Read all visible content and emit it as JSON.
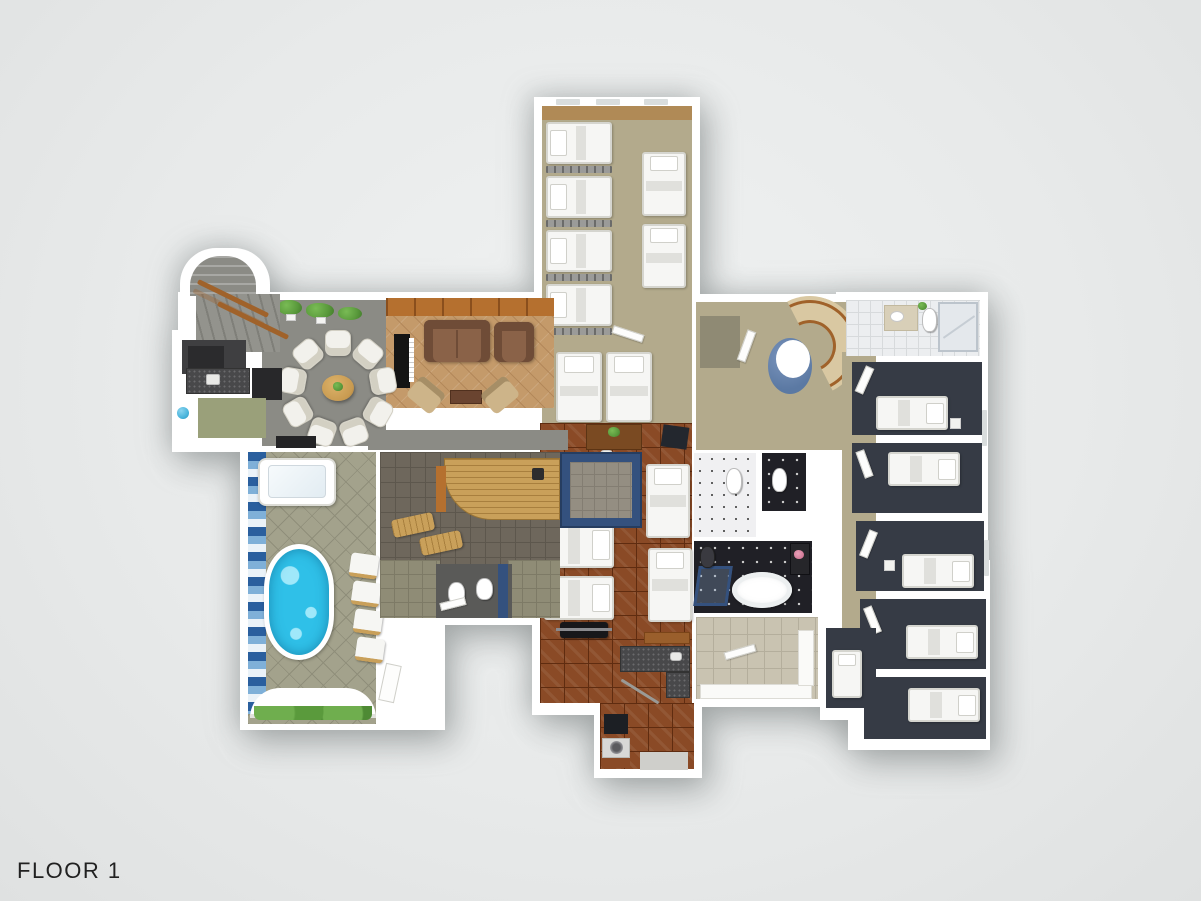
{
  "title": {
    "text": "FLOOR 1"
  },
  "scene": {
    "description": "3D rendered top-down architectural floor plan of first floor"
  },
  "palette": {
    "bg": "#e8eaea",
    "bg_edge": "#dfe1e1",
    "wall": "#ffffff",
    "text": "#212121",
    "carpet_tan": "#b3aa8c",
    "carpet_dark": "#363b45",
    "carpet_gray": "#8b8b85",
    "carpet_olive": "#9aa07a",
    "parquet": "#8a4a26",
    "parquet_line": "#5f2c10",
    "cork": "#c49a6a",
    "cork_line": "#b3885a",
    "beam": "#b5702f",
    "beam_line": "#8a4f1d",
    "sofa": "#8a6248",
    "sofa_dark": "#6f4c37",
    "chair_white": "#f2f1ec",
    "chair_tan": "#cdb489",
    "table_wood": "#c89a50",
    "bed_white": "#f6f6f4",
    "bed_border": "#d5d5cf",
    "pool_water": "#2fc0e8",
    "pool_light": "#9fe8fa",
    "stone": "#a3a28c",
    "stone_line": "#8f8e7a",
    "mosaic_dark": "#2a5f9e",
    "mosaic_mid": "#7fb0d8",
    "mosaic_light": "#eaf2f8",
    "sauna_wood": "#c9a05a",
    "sauna_line": "#a87f3e",
    "shower_blue": "#34517e",
    "shower_floor": "#948e82",
    "bath_dark": "#202026",
    "tile_beige": "#c9c3b1",
    "tile_line": "#b4ae9c",
    "tile_white": "#eceef0",
    "granite": "#48484a",
    "granite_light": "#6a6a6c",
    "stair_tread": "#d9c8a2",
    "rail_wood": "#a0622a",
    "stair_core": "#5b79a3",
    "closet_dark": "#3f3f41",
    "kitchen_dark": "#28282a",
    "plant": "#5a9a3c",
    "plant_dark": "#417a2a"
  }
}
